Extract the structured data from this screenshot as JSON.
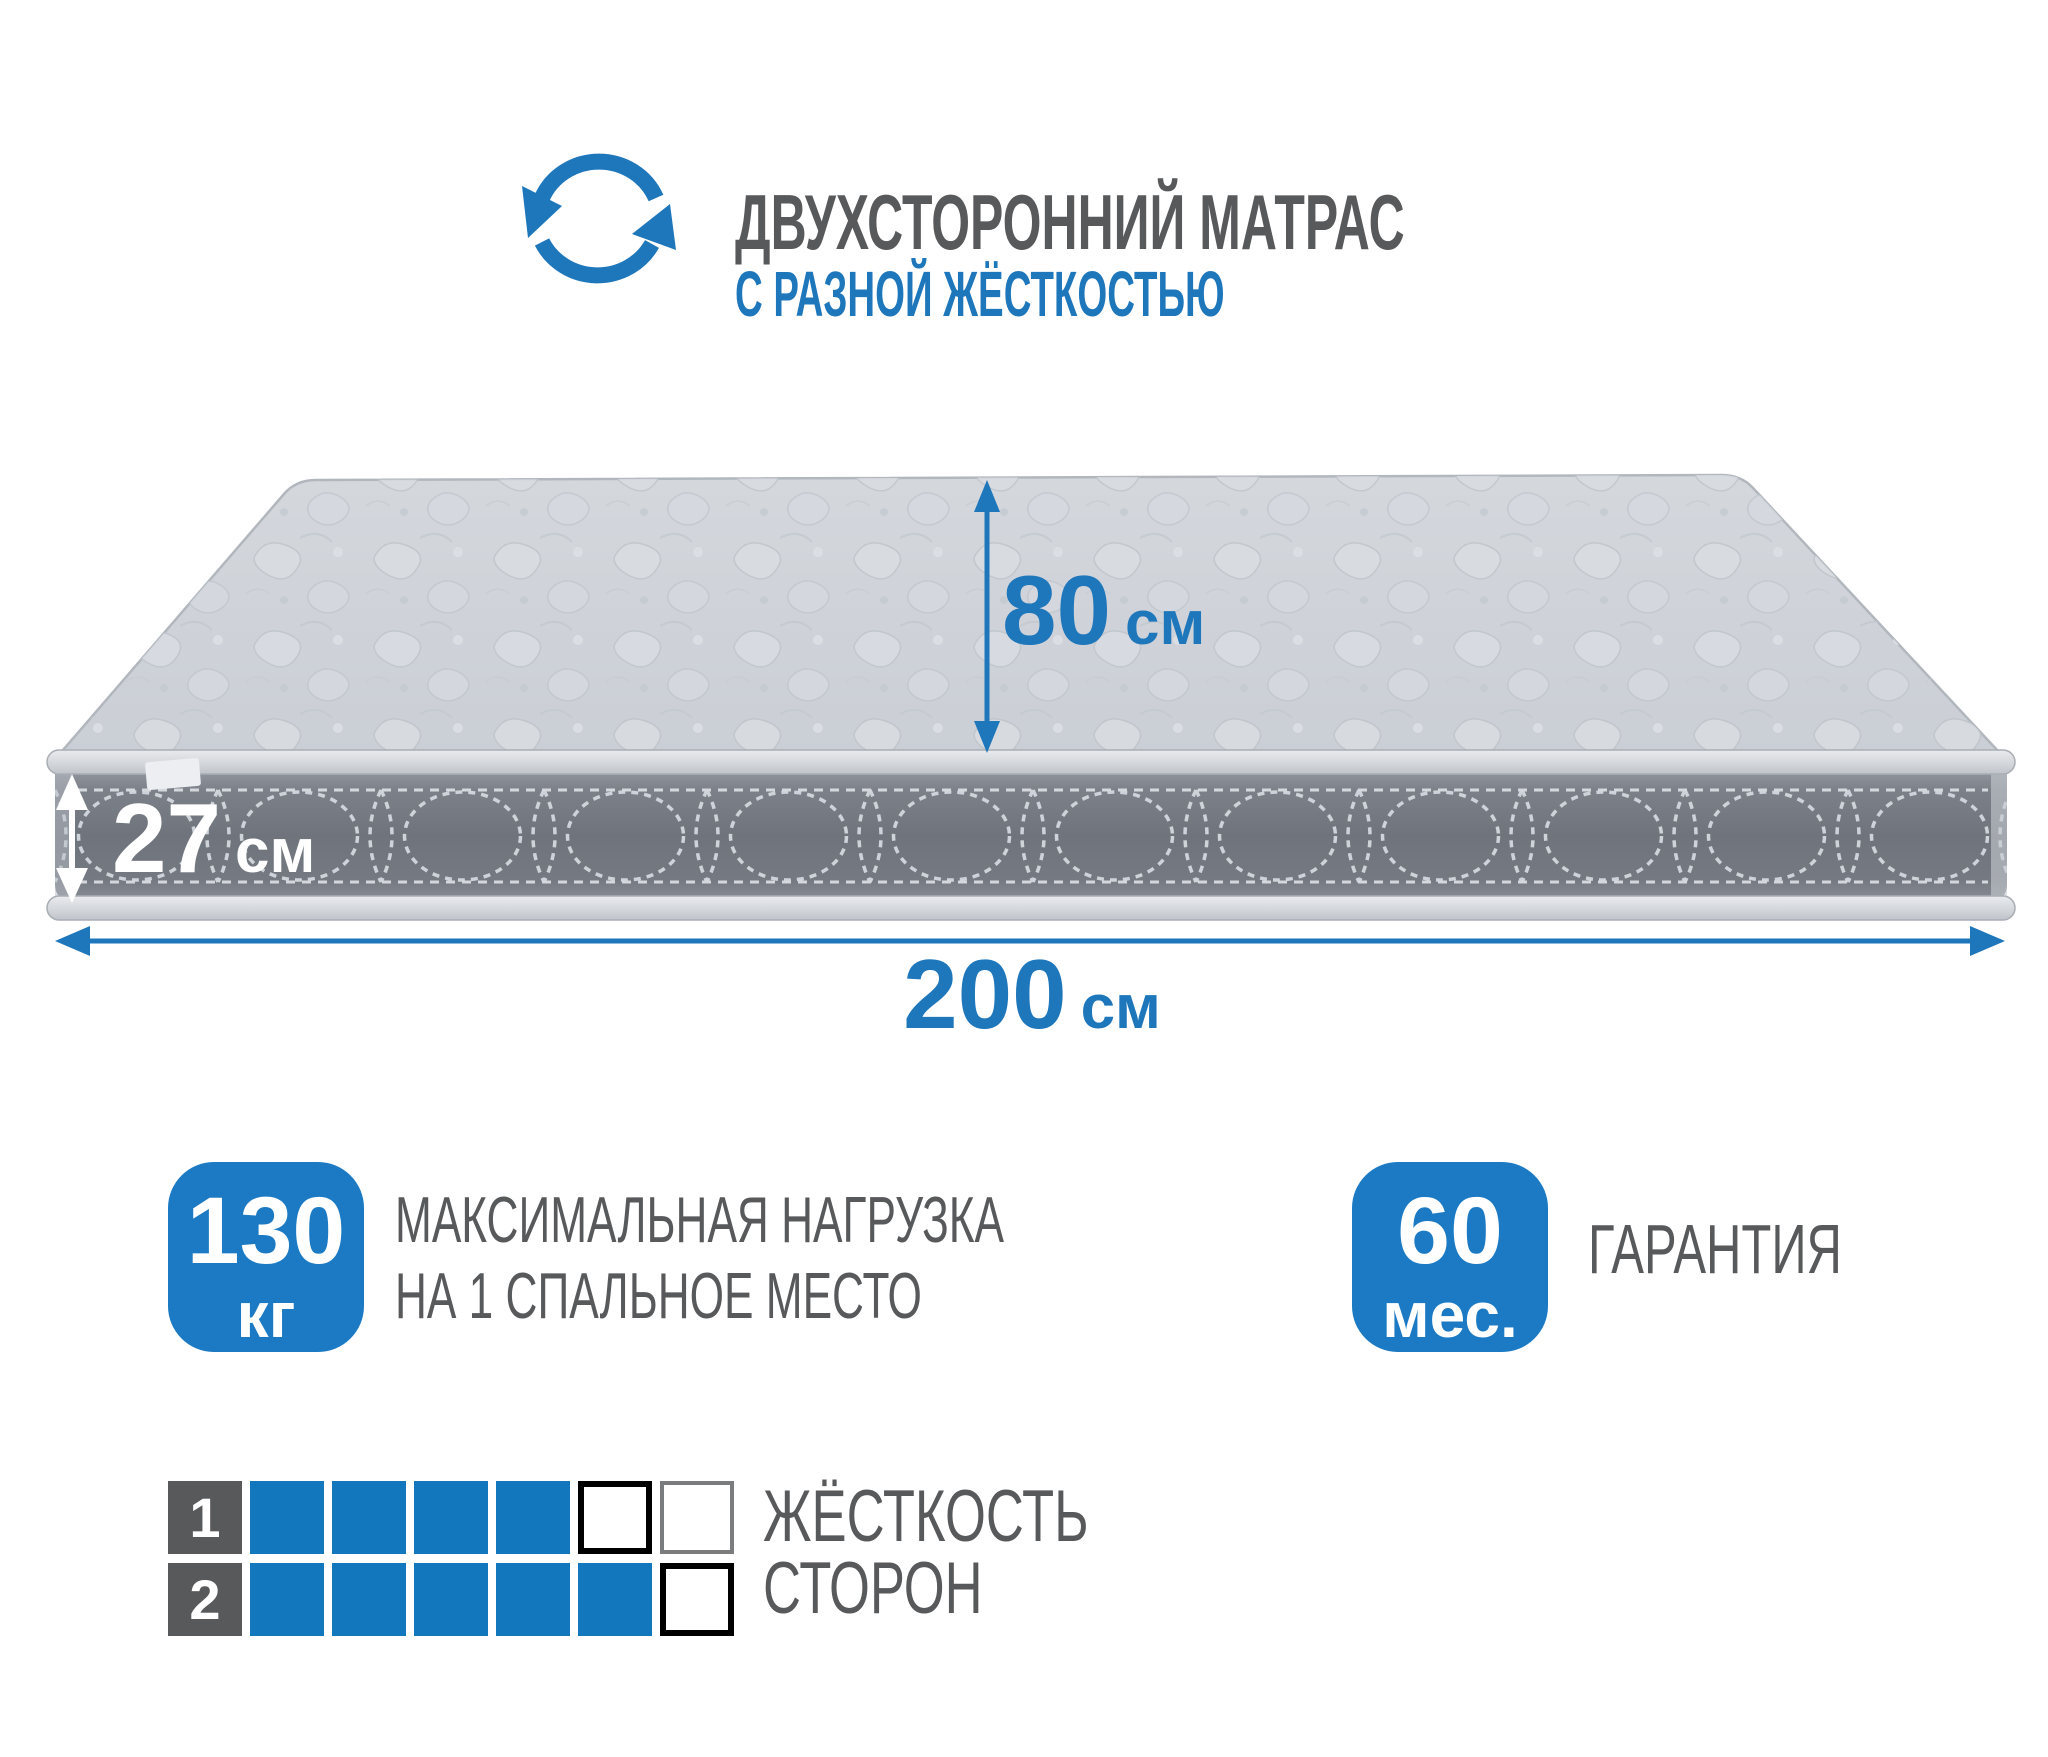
{
  "header": {
    "title": "ДВУХСТОРОННИЙ МАТРАС",
    "subtitle": "С РАЗНОЙ ЖЁСТКОСТЬЮ"
  },
  "mattress": {
    "height": {
      "value": "27",
      "unit": "см"
    },
    "width": {
      "value": "80",
      "unit": "см"
    },
    "length": {
      "value": "200",
      "unit": "см"
    }
  },
  "badges": {
    "max_load": {
      "value": "130",
      "unit": "кг",
      "desc_line1": "МАКСИМАЛЬНАЯ НАГРУЗКА",
      "desc_line2": "НА 1 СПАЛЬНОЕ МЕСТО"
    },
    "warranty": {
      "value": "60",
      "unit": "мес.",
      "label": "ГАРАНТИЯ"
    }
  },
  "hardness": {
    "label_line1": "ЖЁСТКОСТЬ",
    "label_line2": "СТОРОН",
    "scale_max": 6,
    "rows": [
      {
        "label": "1",
        "filled": 4,
        "empty_styles": [
          "black",
          "gray"
        ]
      },
      {
        "label": "2",
        "filled": 5,
        "empty_styles": [
          "black"
        ]
      }
    ]
  },
  "colors": {
    "accent_blue": "#1e76bb",
    "badge_blue": "#1b7ac3",
    "square_blue": "#1377be",
    "text_gray": "#58595b",
    "box_gray": "#58595b"
  }
}
